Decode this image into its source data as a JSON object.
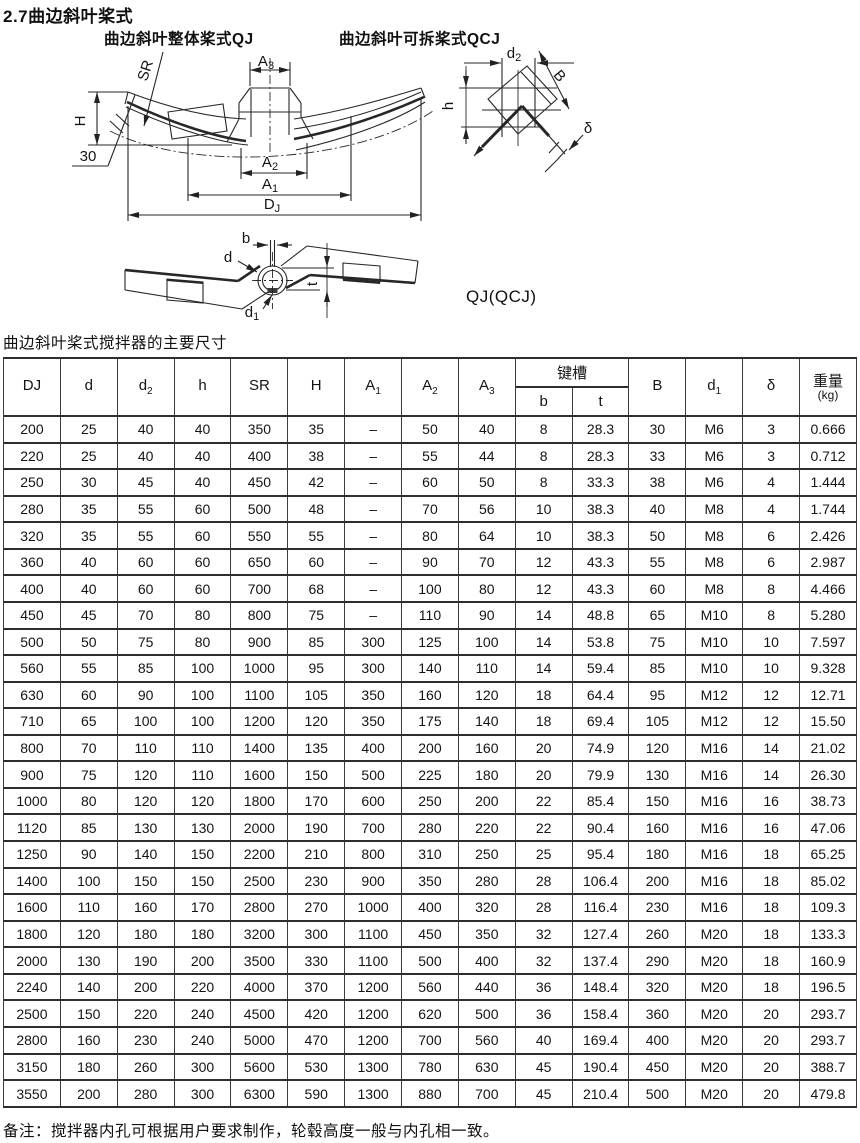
{
  "page": {
    "title": "2.7曲边斜叶桨式",
    "caption": "曲边斜叶桨式搅拌器的主要尺寸",
    "footnote": "备注：搅拌器内孔可根据用户要求制作，轮毂高度一般与内孔相一致。"
  },
  "diagrams": {
    "left_title": "曲边斜叶整体桨式QJ",
    "right_title": "曲边斜叶可拆桨式QCJ",
    "model_label": "QJ(QCJ)",
    "labels": {
      "SR": "SR",
      "H": "H",
      "angle": "30",
      "A3_base": "A",
      "A3_sub": "3",
      "A2_base": "A",
      "A2_sub": "2",
      "A1_base": "A",
      "A1_sub": "1",
      "DJ_base": "D",
      "DJ_sub": "J",
      "d2_base": "d",
      "d2_sub": "2",
      "B": "B",
      "h": "h",
      "delta": "δ",
      "b": "b",
      "d": "d",
      "t": "t",
      "d1_base": "d",
      "d1_sub": "1"
    }
  },
  "table": {
    "headers": [
      {
        "b": "DJ",
        "s": ""
      },
      {
        "b": "d",
        "s": ""
      },
      {
        "b": "d",
        "s": "2"
      },
      {
        "b": "h",
        "s": ""
      },
      {
        "b": "SR",
        "s": ""
      },
      {
        "b": "H",
        "s": ""
      },
      {
        "b": "A",
        "s": "1"
      },
      {
        "b": "A",
        "s": "2"
      },
      {
        "b": "A",
        "s": "3"
      }
    ],
    "keyway": {
      "label": "键槽",
      "sub": [
        "b",
        "t"
      ]
    },
    "tail_headers": [
      {
        "b": "B",
        "s": ""
      },
      {
        "b": "d",
        "s": "1"
      },
      {
        "b": "δ",
        "s": ""
      }
    ],
    "weight": {
      "label": "重量",
      "unit": "(kg)"
    },
    "rows": [
      [
        "200",
        "25",
        "40",
        "40",
        "350",
        "35",
        "–",
        "50",
        "40",
        "8",
        "28.3",
        "30",
        "M6",
        "3",
        "0.666"
      ],
      [
        "220",
        "25",
        "40",
        "40",
        "400",
        "38",
        "–",
        "55",
        "44",
        "8",
        "28.3",
        "33",
        "M6",
        "3",
        "0.712"
      ],
      [
        "250",
        "30",
        "45",
        "40",
        "450",
        "42",
        "–",
        "60",
        "50",
        "8",
        "33.3",
        "38",
        "M6",
        "4",
        "1.444"
      ],
      [
        "280",
        "35",
        "55",
        "60",
        "500",
        "48",
        "–",
        "70",
        "56",
        "10",
        "38.3",
        "40",
        "M8",
        "4",
        "1.744"
      ],
      [
        "320",
        "35",
        "55",
        "60",
        "550",
        "55",
        "–",
        "80",
        "64",
        "10",
        "38.3",
        "50",
        "M8",
        "6",
        "2.426"
      ],
      [
        "360",
        "40",
        "60",
        "60",
        "650",
        "60",
        "–",
        "90",
        "70",
        "12",
        "43.3",
        "55",
        "M8",
        "6",
        "2.987"
      ],
      [
        "400",
        "40",
        "60",
        "60",
        "700",
        "68",
        "–",
        "100",
        "80",
        "12",
        "43.3",
        "60",
        "M8",
        "8",
        "4.466"
      ],
      [
        "450",
        "45",
        "70",
        "80",
        "800",
        "75",
        "–",
        "110",
        "90",
        "14",
        "48.8",
        "65",
        "M10",
        "8",
        "5.280"
      ],
      [
        "500",
        "50",
        "75",
        "80",
        "900",
        "85",
        "300",
        "125",
        "100",
        "14",
        "53.8",
        "75",
        "M10",
        "10",
        "7.597"
      ],
      [
        "560",
        "55",
        "85",
        "100",
        "1000",
        "95",
        "300",
        "140",
        "110",
        "14",
        "59.4",
        "85",
        "M10",
        "10",
        "9.328"
      ],
      [
        "630",
        "60",
        "90",
        "100",
        "1100",
        "105",
        "350",
        "160",
        "120",
        "18",
        "64.4",
        "95",
        "M12",
        "12",
        "12.71"
      ],
      [
        "710",
        "65",
        "100",
        "100",
        "1200",
        "120",
        "350",
        "175",
        "140",
        "18",
        "69.4",
        "105",
        "M12",
        "12",
        "15.50"
      ],
      [
        "800",
        "70",
        "110",
        "110",
        "1400",
        "135",
        "400",
        "200",
        "160",
        "20",
        "74.9",
        "120",
        "M16",
        "14",
        "21.02"
      ],
      [
        "900",
        "75",
        "120",
        "110",
        "1600",
        "150",
        "500",
        "225",
        "180",
        "20",
        "79.9",
        "130",
        "M16",
        "14",
        "26.30"
      ],
      [
        "1000",
        "80",
        "120",
        "120",
        "1800",
        "170",
        "600",
        "250",
        "200",
        "22",
        "85.4",
        "150",
        "M16",
        "16",
        "38.73"
      ],
      [
        "1120",
        "85",
        "130",
        "130",
        "2000",
        "190",
        "700",
        "280",
        "220",
        "22",
        "90.4",
        "160",
        "M16",
        "16",
        "47.06"
      ],
      [
        "1250",
        "90",
        "140",
        "150",
        "2200",
        "210",
        "800",
        "310",
        "250",
        "25",
        "95.4",
        "180",
        "M16",
        "18",
        "65.25"
      ],
      [
        "1400",
        "100",
        "150",
        "150",
        "2500",
        "230",
        "900",
        "350",
        "280",
        "28",
        "106.4",
        "200",
        "M16",
        "18",
        "85.02"
      ],
      [
        "1600",
        "110",
        "160",
        "170",
        "2800",
        "270",
        "1000",
        "400",
        "320",
        "28",
        "116.4",
        "230",
        "M16",
        "18",
        "109.3"
      ],
      [
        "1800",
        "120",
        "180",
        "180",
        "3200",
        "300",
        "1100",
        "450",
        "350",
        "32",
        "127.4",
        "260",
        "M20",
        "18",
        "133.3"
      ],
      [
        "2000",
        "130",
        "190",
        "200",
        "3500",
        "330",
        "1100",
        "500",
        "400",
        "32",
        "137.4",
        "290",
        "M20",
        "18",
        "160.9"
      ],
      [
        "2240",
        "140",
        "200",
        "220",
        "4000",
        "370",
        "1200",
        "560",
        "440",
        "36",
        "148.4",
        "320",
        "M20",
        "18",
        "196.5"
      ],
      [
        "2500",
        "150",
        "220",
        "240",
        "4500",
        "420",
        "1200",
        "620",
        "500",
        "36",
        "158.4",
        "360",
        "M20",
        "20",
        "293.7"
      ],
      [
        "2800",
        "160",
        "230",
        "240",
        "5000",
        "470",
        "1200",
        "700",
        "560",
        "40",
        "169.4",
        "400",
        "M20",
        "20",
        "293.7"
      ],
      [
        "3150",
        "180",
        "260",
        "300",
        "5600",
        "530",
        "1300",
        "780",
        "630",
        "45",
        "190.4",
        "450",
        "M20",
        "20",
        "388.7"
      ],
      [
        "3550",
        "200",
        "280",
        "300",
        "6300",
        "590",
        "1300",
        "880",
        "700",
        "45",
        "210.4",
        "500",
        "M20",
        "20",
        "479.8"
      ]
    ]
  }
}
